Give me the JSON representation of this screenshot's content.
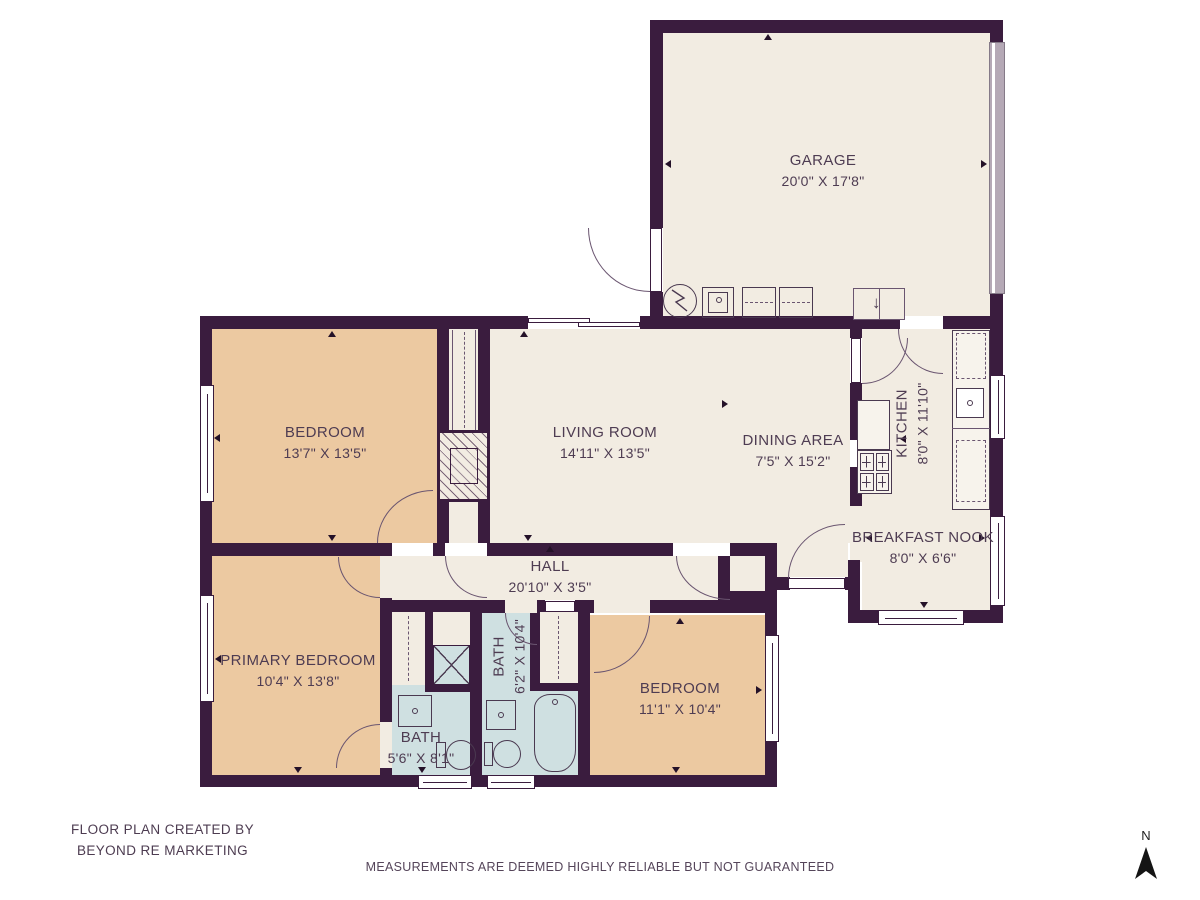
{
  "rooms": [
    {
      "name": "GARAGE",
      "dims": "20'0\" X 17'8\""
    },
    {
      "name": "BEDROOM",
      "dims": "13'7\" X 13'5\""
    },
    {
      "name": "LIVING ROOM",
      "dims": "14'11\" X 13'5\""
    },
    {
      "name": "DINING AREA",
      "dims": "7'5\" X 15'2\""
    },
    {
      "name": "KITCHEN",
      "dims": "8'0\" X 11'10\""
    },
    {
      "name": "BREAKFAST NOOK",
      "dims": "8'0\" X 6'6\""
    },
    {
      "name": "HALL",
      "dims": "20'10\" X 3'5\""
    },
    {
      "name": "PRIMARY BEDROOM",
      "dims": "10'4\" X 13'8\""
    },
    {
      "name": "BATH",
      "dims": "5'6\" X 8'1\""
    },
    {
      "name": "BATH",
      "dims": "6'2\" X 10'4\""
    },
    {
      "name": "BEDROOM",
      "dims": "11'1\" X 10'4\""
    }
  ],
  "footer": {
    "credit_line1": "FLOOR PLAN CREATED BY",
    "credit_line2": "BEYOND RE MARKETING",
    "disclaimer": "MEASUREMENTS ARE DEEMED HIGHLY RELIABLE BUT NOT GUARANTEED"
  },
  "compass": {
    "label": "N"
  },
  "colors": {
    "wall": "#3a1c3e",
    "floor_main": "#f2ece2",
    "floor_bedroom": "#ecc9a1",
    "floor_bath": "#cfe0e1",
    "garage_door": "#b5a9b6",
    "label_text": "#4e3c52"
  }
}
